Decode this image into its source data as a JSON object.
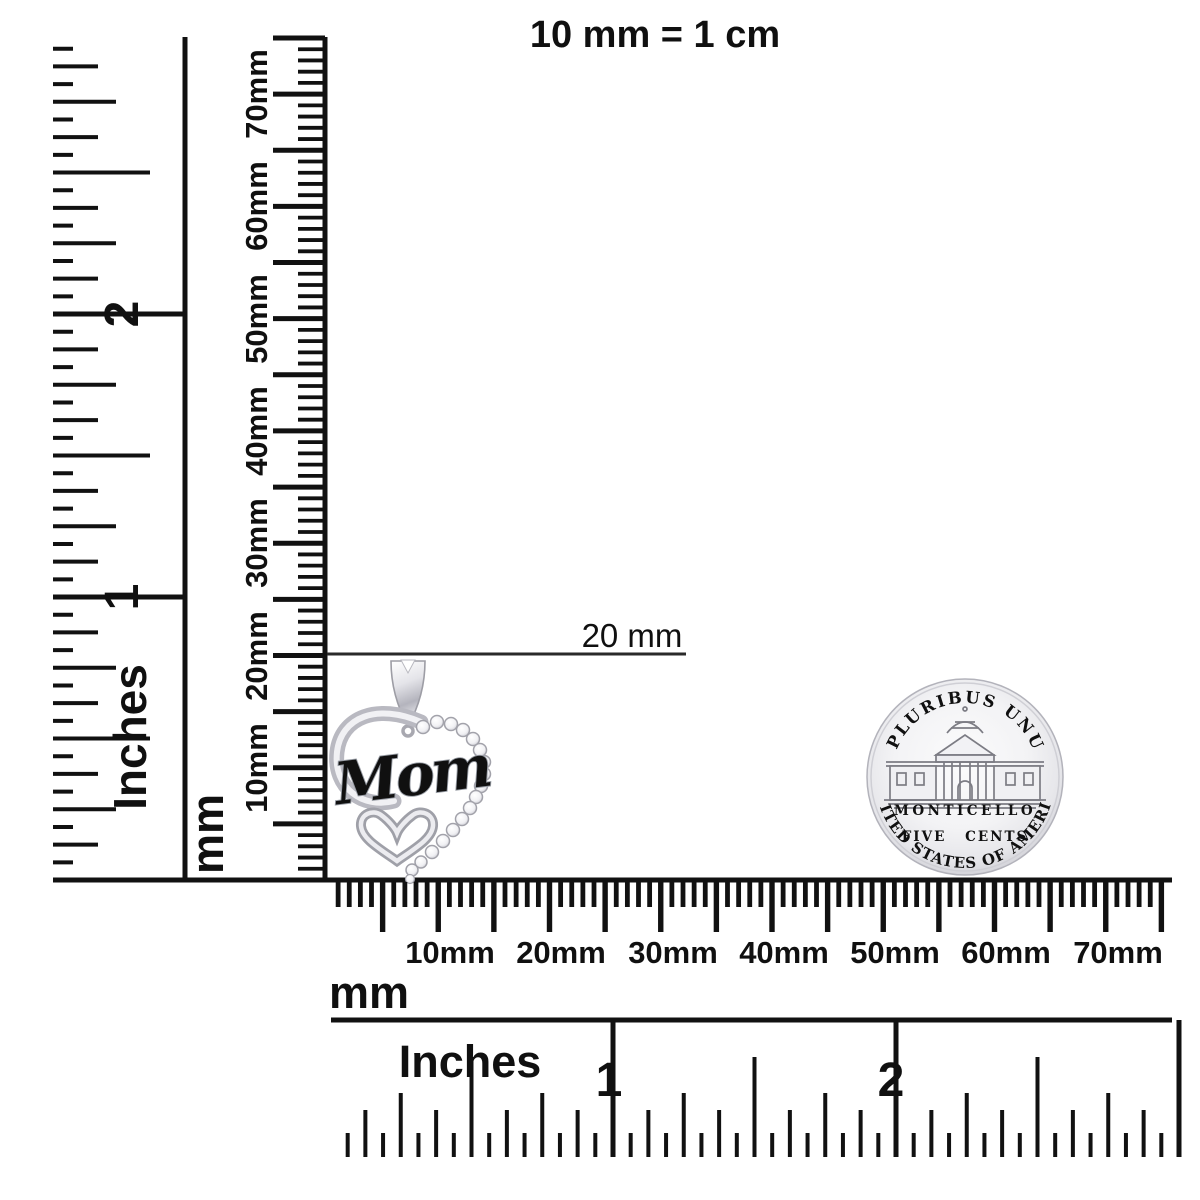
{
  "title": "10 mm = 1 cm",
  "callout": {
    "label": "20 mm"
  },
  "rulers": {
    "left_inches": {
      "unit": "Inches",
      "marks": [
        "1",
        "2"
      ]
    },
    "left_mm": {
      "unit": "mm",
      "marks": [
        "10mm",
        "20mm",
        "30mm",
        "40mm",
        "50mm",
        "60mm",
        "70mm"
      ]
    },
    "bottom_mm": {
      "unit": "mm",
      "marks": [
        "10mm",
        "20mm",
        "30mm",
        "40mm",
        "50mm",
        "60mm",
        "70mm"
      ]
    },
    "bottom_inches": {
      "unit": "Inches",
      "marks": [
        "1",
        "2"
      ]
    }
  },
  "pendant": {
    "engraving": "Mom"
  },
  "coin": {
    "top_legend": "E PLURIBUS UNUM",
    "building_label": "MONTICELLO",
    "denomination": "FIVE CENTS",
    "bottom_legend": "UNITED STATES OF AMERICA"
  },
  "colors": {
    "ink": "#111111",
    "coin_text": "#6d6d75",
    "silver": "#d8d8dd"
  }
}
